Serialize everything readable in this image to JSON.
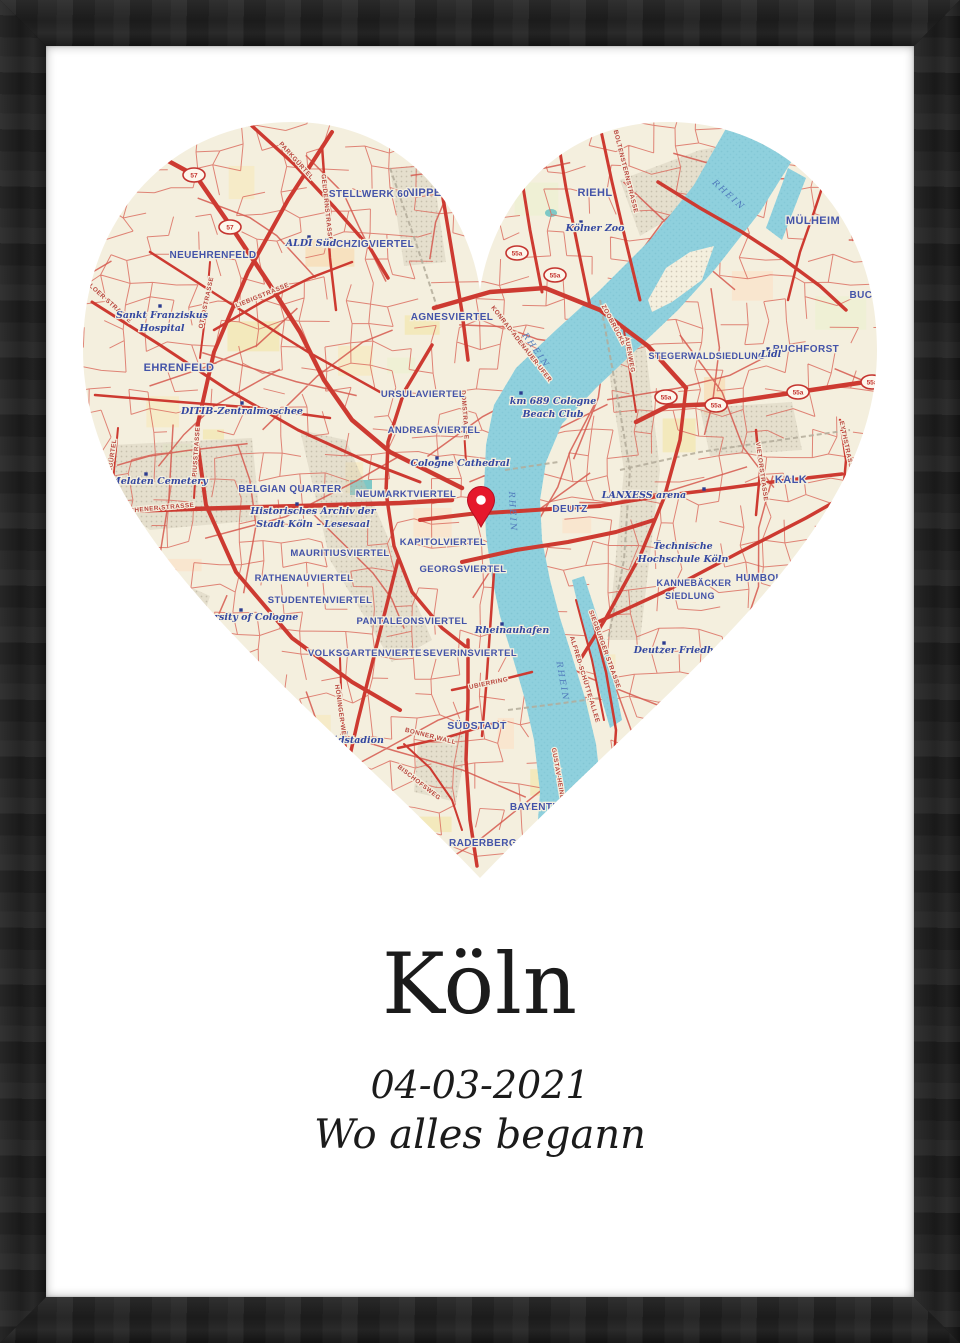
{
  "poster": {
    "city": "Köln",
    "date": "04-03-2021",
    "subtitle": "Wo alles begann"
  },
  "frame": {
    "color": "#1e1e1e",
    "paper_color": "#ffffff"
  },
  "map": {
    "shape": "heart",
    "colors": {
      "land": "#f4efde",
      "water": "#8fd0dd",
      "water_texture": "#7cc2d1",
      "road_major": "#cd3a31",
      "road_minor": "#db6b5e",
      "railway": "#b3ab9a",
      "district_label": "#4353a8",
      "poi_label": "#3347a0",
      "street_label": "#b8463e",
      "water_label": "#4f79bb",
      "shield_red": "#c4332e",
      "marker": "#e5182c"
    },
    "marker": {
      "x": 481,
      "y": 527
    },
    "district_labels": [
      {
        "text": "STÖCKCHEN",
        "x": 527,
        "y": 142,
        "s": 10
      },
      {
        "text": "NIPPES",
        "x": 428,
        "y": 196,
        "s": 11
      },
      {
        "text": "STELLWERK 60",
        "x": 369,
        "y": 197,
        "s": 10
      },
      {
        "text": "RIEHL",
        "x": 595,
        "y": 196,
        "s": 11
      },
      {
        "text": "MÜLHEIM",
        "x": 813,
        "y": 224,
        "s": 11
      },
      {
        "text": "SECHZIGVIERTEL",
        "x": 368,
        "y": 247,
        "s": 10
      },
      {
        "text": "NEUEHRENFELD",
        "x": 213,
        "y": 258,
        "s": 10
      },
      {
        "text": "AGNESVIERTEL",
        "x": 452,
        "y": 320,
        "s": 10
      },
      {
        "text": "STEGERWALDSIEDLUNG",
        "x": 707,
        "y": 359,
        "s": 9
      },
      {
        "text": "BUCHFORST",
        "x": 806,
        "y": 352,
        "s": 10
      },
      {
        "text": "BUCHHEIM",
        "x": 878,
        "y": 298,
        "s": 10
      },
      {
        "text": "EHRENFELD",
        "x": 179,
        "y": 371,
        "s": 11
      },
      {
        "text": "URSULAVIERTEL",
        "x": 423,
        "y": 397,
        "s": 9.5
      },
      {
        "text": "ANDREASVIERTEL",
        "x": 434,
        "y": 433,
        "s": 9.5
      },
      {
        "text": "BELGIAN QUARTER",
        "x": 290,
        "y": 492,
        "s": 10
      },
      {
        "text": "NEUMARKTVIERTEL",
        "x": 406,
        "y": 497,
        "s": 9.5
      },
      {
        "text": "KALK",
        "x": 791,
        "y": 483,
        "s": 11
      },
      {
        "text": "DEUTZ",
        "x": 570,
        "y": 512,
        "s": 10
      },
      {
        "text": "KAPITOLVIERTEL",
        "x": 443,
        "y": 545,
        "s": 9.5
      },
      {
        "text": "MAURITIUSVIERTEL",
        "x": 340,
        "y": 556,
        "s": 9.5
      },
      {
        "text": "GEORGSVIERTEL",
        "x": 463,
        "y": 572,
        "s": 9.5
      },
      {
        "text": "HUMBOLDT",
        "x": 766,
        "y": 581,
        "s": 10
      },
      {
        "text": "RATHENAUVIERTEL",
        "x": 304,
        "y": 581,
        "s": 9.5
      },
      {
        "text": "KANNEBÄCKER",
        "x": 694,
        "y": 586,
        "s": 9
      },
      {
        "text": "SIEDLUNG",
        "x": 690,
        "y": 599,
        "s": 9
      },
      {
        "text": "STUDENTENVIERTEL",
        "x": 320,
        "y": 603,
        "s": 9.5
      },
      {
        "text": "PANTALEONSVIERTEL",
        "x": 412,
        "y": 624,
        "s": 9.5
      },
      {
        "text": "VOLKSGARTENVIERTEL",
        "x": 368,
        "y": 656,
        "s": 9.5
      },
      {
        "text": "SEVERINSVIERTEL",
        "x": 470,
        "y": 656,
        "s": 9.5
      },
      {
        "text": "SÜDSTADT",
        "x": 477,
        "y": 729,
        "s": 10.5
      },
      {
        "text": "BAYENTHAL",
        "x": 542,
        "y": 810,
        "s": 10
      },
      {
        "text": "RADERBERG",
        "x": 483,
        "y": 846,
        "s": 10
      }
    ],
    "poi_labels": [
      {
        "text": "Sankt Franziskus",
        "x": 162,
        "y": 318
      },
      {
        "text": "Hospital",
        "x": 162,
        "y": 331
      },
      {
        "text": "ALDI Süd",
        "x": 311,
        "y": 246
      },
      {
        "text": "Kölner Zoo",
        "x": 595,
        "y": 231
      },
      {
        "text": "Lidl",
        "x": 771,
        "y": 357
      },
      {
        "text": "km 689 Cologne",
        "x": 553,
        "y": 404
      },
      {
        "text": "Beach Club",
        "x": 553,
        "y": 417
      },
      {
        "text": "DITIB-Zentralmoschee",
        "x": 242,
        "y": 414
      },
      {
        "text": "Cologne Cathedral",
        "x": 460,
        "y": 466
      },
      {
        "text": "Melaten Cemetery",
        "x": 159,
        "y": 484
      },
      {
        "text": "Historisches Archiv der",
        "x": 313,
        "y": 514
      },
      {
        "text": "Stadt Köln – Lesesaal",
        "x": 313,
        "y": 527
      },
      {
        "text": "LANXESS arena",
        "x": 644,
        "y": 498
      },
      {
        "text": "Technische",
        "x": 683,
        "y": 549
      },
      {
        "text": "Hochschule Köln",
        "x": 683,
        "y": 562
      },
      {
        "text": "University of Cologne",
        "x": 241,
        "y": 620
      },
      {
        "text": "Rheinauhafen",
        "x": 512,
        "y": 633
      },
      {
        "text": "Deutzer Friedhof",
        "x": 679,
        "y": 653
      },
      {
        "text": "Südstadion",
        "x": 354,
        "y": 743
      }
    ],
    "street_labels": [
      {
        "text": "PARKGÜRTEL",
        "x": 295,
        "y": 162,
        "r": 48
      },
      {
        "text": "GELDERNSTRASSE",
        "x": 325,
        "y": 208,
        "r": 84
      },
      {
        "text": "OTTOSTRASSE",
        "x": 208,
        "y": 303,
        "r": -78
      },
      {
        "text": "LIEBIGSTRASSE",
        "x": 263,
        "y": 297,
        "r": -22
      },
      {
        "text": "VENLOER STRASSE",
        "x": 104,
        "y": 300,
        "r": 42
      },
      {
        "text": "MELATENGÜRTEL",
        "x": 112,
        "y": 470,
        "r": -82
      },
      {
        "text": "PIUSSTRASSE",
        "x": 198,
        "y": 452,
        "r": -86
      },
      {
        "text": "AACHENER STRASSE",
        "x": 157,
        "y": 510,
        "r": -5
      },
      {
        "text": "BOLTENSTERNSTRASSE",
        "x": 624,
        "y": 172,
        "r": 76
      },
      {
        "text": "KONRAD-ADENAUER-UFER",
        "x": 520,
        "y": 345,
        "r": 52
      },
      {
        "text": "ZOOBRÜCKE",
        "x": 612,
        "y": 326,
        "r": 62
      },
      {
        "text": "AUENWEG",
        "x": 628,
        "y": 355,
        "r": 80
      },
      {
        "text": "DOMSTRASSE",
        "x": 463,
        "y": 415,
        "r": 86
      },
      {
        "text": "EYTHSTRASSE",
        "x": 845,
        "y": 447,
        "r": 78
      },
      {
        "text": "VIETORSTRASSE",
        "x": 760,
        "y": 472,
        "r": 82
      },
      {
        "text": "SIEGBURGER STRASSE",
        "x": 603,
        "y": 650,
        "r": 70
      },
      {
        "text": "ALFRED-SCHÜTTE-ALLEE",
        "x": 583,
        "y": 680,
        "r": 73
      },
      {
        "text": "UBIERRING",
        "x": 489,
        "y": 685,
        "r": -12
      },
      {
        "text": "BONNER WALL",
        "x": 430,
        "y": 738,
        "r": 14
      },
      {
        "text": "HÖNINGER WEG",
        "x": 339,
        "y": 713,
        "r": 82
      },
      {
        "text": "BISCHOFSWEG",
        "x": 418,
        "y": 784,
        "r": 38
      },
      {
        "text": "GUSTAV-HEINEMANN-UFER",
        "x": 560,
        "y": 795,
        "r": 80
      }
    ],
    "water_labels": [
      {
        "text": "RHEIN",
        "x": 727,
        "y": 197,
        "r": 42
      },
      {
        "text": "RHEIN",
        "x": 534,
        "y": 352,
        "r": 55
      },
      {
        "text": "RHEIN",
        "x": 510,
        "y": 512,
        "r": 87
      },
      {
        "text": "RHEIN",
        "x": 560,
        "y": 682,
        "r": 80
      }
    ],
    "route_shields": [
      {
        "text": "57",
        "x": 194,
        "y": 175
      },
      {
        "text": "57",
        "x": 230,
        "y": 227
      },
      {
        "text": "55a",
        "x": 517,
        "y": 253
      },
      {
        "text": "55a",
        "x": 555,
        "y": 275
      },
      {
        "text": "55a",
        "x": 666,
        "y": 397
      },
      {
        "text": "55a",
        "x": 716,
        "y": 405
      },
      {
        "text": "55a",
        "x": 798,
        "y": 392
      },
      {
        "text": "55a",
        "x": 872,
        "y": 382
      }
    ]
  }
}
